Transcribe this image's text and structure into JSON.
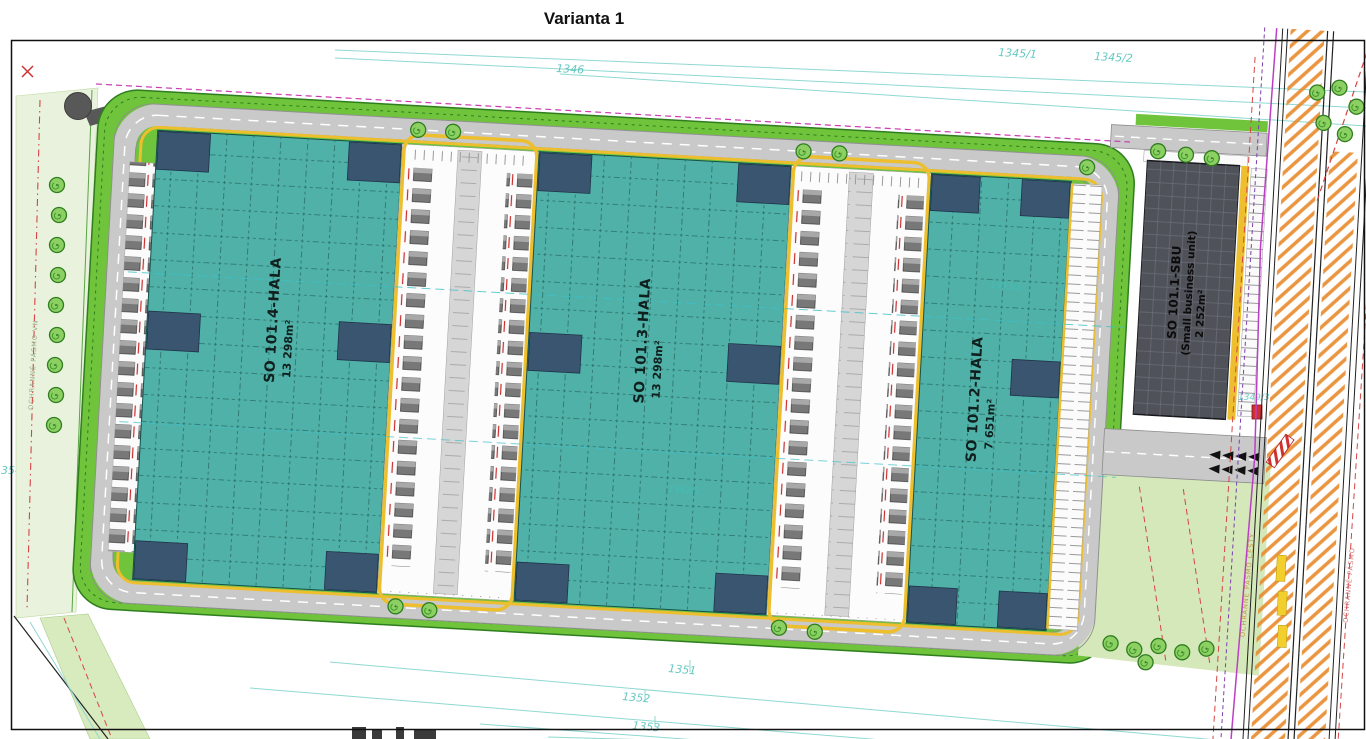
{
  "title": "Varianta 1",
  "buildings": {
    "hall4": {
      "name": "SO 101.4-HALA",
      "area": "13 298m²"
    },
    "hall3": {
      "name": "SO 101.3-HALA",
      "area": "13 298m²"
    },
    "hall2": {
      "name": "SO 101.2-HALA",
      "area": "7 651m²"
    },
    "sbu": {
      "name": "SO 101.1-SBU",
      "subtitle": "(Small business unit)",
      "area": "2 252m²"
    }
  },
  "parcels": {
    "p1346": "1346",
    "p1345_1": "1345/1",
    "p1345_2": "1345/2",
    "p1351": "1351",
    "p1352": "1352",
    "p1353": "1353",
    "p1354": "1354",
    "p1342_1": "1342/1",
    "p1343_1": "1343/1",
    "p1349_3": "1349/3"
  },
  "easements": {
    "left": "OCHRANNÉ PÁSMO VN",
    "road": "OCHRANNÉ PÁSMO CESTY",
    "right": "OCHRANNÉ PÁSMO"
  },
  "colors": {
    "hall_teal": "#4fb1a8",
    "hall_grid": "#2a6e66",
    "corner_block": "#3a5570",
    "green_border": "#6fc43c",
    "pale_green": "#d4e8ba",
    "road_gray": "#c9c9c9",
    "curb_yellow": "#edbf2e",
    "sbu_dark": "#50525a",
    "parcel_cyan": "#3fbab2",
    "utility_magenta": "#bb3fc4",
    "easement_red": "#d64545",
    "road_hatch_orange": "#e8892b"
  }
}
